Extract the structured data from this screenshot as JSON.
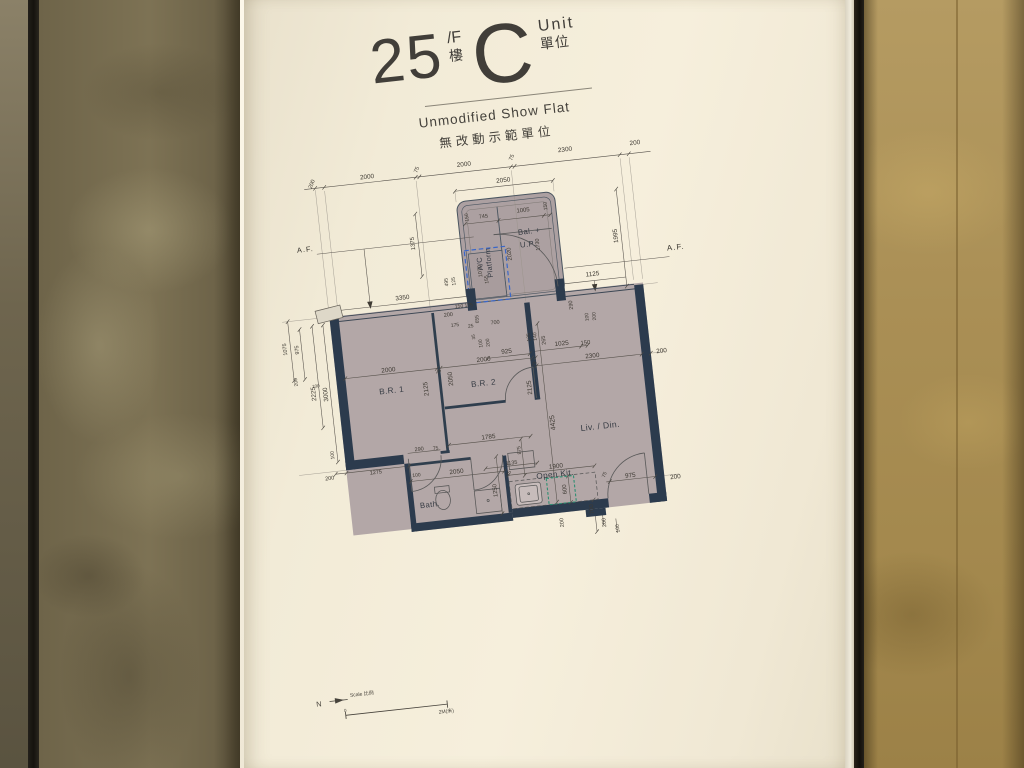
{
  "poster": {
    "title": {
      "floor": "25",
      "floor_sup": "/F",
      "floor_cjk": "樓",
      "unit": "C",
      "unit_en": "Unit",
      "unit_cjk": "單位"
    },
    "subtitle_en": "Unmodified Show Flat",
    "subtitle_cjk": "無改動示範單位"
  },
  "plan": {
    "rooms": [
      {
        "t": "B.R. 1",
        "x": 129,
        "y": 268,
        "s": 9
      },
      {
        "t": "B.R. 2",
        "x": 230,
        "y": 271,
        "s": 9
      },
      {
        "t": "Liv. / Din.",
        "x": 352,
        "y": 332,
        "s": 9.5
      },
      {
        "t": "Bath.",
        "x": 157,
        "y": 397,
        "s": 8.5
      },
      {
        "t": "Open Kit.",
        "x": 297,
        "y": 379,
        "s": 9
      },
      {
        "t": "Bal. +",
        "x": 298,
        "y": 111,
        "s": 8.5
      },
      {
        "t": "U.P.",
        "x": 295,
        "y": 125,
        "s": 8.5
      },
      {
        "t": "A/C",
        "x": 241,
        "y": 140,
        "s": 8,
        "r": -90
      },
      {
        "t": "Platform",
        "x": 251,
        "y": 140,
        "s": 8,
        "r": -90
      }
    ],
    "af_labels": [
      {
        "t": "A.F.",
        "x": 52,
        "y": 104,
        "s": 8
      },
      {
        "t": "A.F.",
        "x": 456,
        "y": 146,
        "s": 8.5
      }
    ],
    "misc": [
      {
        "t": "N",
        "x": 12,
        "y": 601,
        "s": 8
      },
      {
        "t": "Scale 比例",
        "x": 60,
        "y": 595,
        "s": 5.5
      },
      {
        "t": "0",
        "x": 40,
        "y": 611,
        "s": 5
      },
      {
        "t": "2M(米)",
        "x": 150,
        "y": 624,
        "s": 5.5
      }
    ],
    "dims": [
      {
        "t": "200",
        "x": 67,
        "y": 33,
        "r": -62,
        "s": 6
      },
      {
        "t": "2000",
        "x": 128,
        "y": 32,
        "s": 7
      },
      {
        "t": "75",
        "x": 183,
        "y": 30,
        "r": -62,
        "s": 6
      },
      {
        "t": "2000",
        "x": 235,
        "y": 30,
        "s": 7
      },
      {
        "t": "75",
        "x": 288,
        "y": 28,
        "r": -62,
        "s": 6
      },
      {
        "t": "2300",
        "x": 347,
        "y": 26,
        "s": 7
      },
      {
        "t": "200",
        "x": 424,
        "y": 27,
        "s": 7
      },
      {
        "t": "2050",
        "x": 276,
        "y": 52,
        "s": 7
      },
      {
        "t": "150",
        "x": 232,
        "y": 88,
        "r": -90,
        "s": 5.5
      },
      {
        "t": "745",
        "x": 250,
        "y": 89,
        "s": 6
      },
      {
        "t": "1005",
        "x": 294,
        "y": 87,
        "s": 6.5
      },
      {
        "t": "150",
        "x": 319,
        "y": 85,
        "r": -90,
        "s": 5.5
      },
      {
        "t": "1070",
        "x": 240,
        "y": 148,
        "r": -90,
        "s": 6
      },
      {
        "t": "2020",
        "x": 274,
        "y": 133,
        "r": -90,
        "s": 6.5
      },
      {
        "t": "1730",
        "x": 306,
        "y": 126,
        "r": -90,
        "s": 6
      },
      {
        "t": "290",
        "x": 335,
        "y": 196,
        "r": -90,
        "s": 6
      },
      {
        "t": "155",
        "x": 246,
        "y": 158,
        "r": -90,
        "s": 5.5
      },
      {
        "t": "1995",
        "x": 392,
        "y": 126,
        "r": -90,
        "s": 7
      },
      {
        "t": "1375",
        "x": 170,
        "y": 110,
        "r": -90,
        "s": 6.5
      },
      {
        "t": "3350",
        "x": 152,
        "y": 168,
        "s": 7
      },
      {
        "t": "495",
        "x": 202,
        "y": 156,
        "r": -90,
        "s": 5.5
      },
      {
        "t": "125",
        "x": 210,
        "y": 156,
        "r": -90,
        "s": 5.5
      },
      {
        "t": "150 175",
        "x": 218,
        "y": 184,
        "s": 5.5
      },
      {
        "t": "200",
        "x": 200,
        "y": 192,
        "s": 6
      },
      {
        "t": "175",
        "x": 206,
        "y": 204,
        "s": 5.5
      },
      {
        "t": "25",
        "x": 223,
        "y": 207,
        "s": 5.5
      },
      {
        "t": "655",
        "x": 231,
        "y": 200,
        "r": -90,
        "s": 5.5
      },
      {
        "t": "700",
        "x": 250,
        "y": 206,
        "s": 6
      },
      {
        "t": "35",
        "x": 225,
        "y": 219,
        "r": -90,
        "s": 5
      },
      {
        "t": "100",
        "x": 232,
        "y": 227,
        "r": -90,
        "s": 5.5
      },
      {
        "t": "200",
        "x": 240,
        "y": 227,
        "r": -90,
        "s": 5.5
      },
      {
        "t": "1125",
        "x": 362,
        "y": 165,
        "s": 7
      },
      {
        "t": "925",
        "x": 259,
        "y": 239,
        "s": 7
      },
      {
        "t": "125",
        "x": 285,
        "y": 226,
        "r": -90,
        "s": 5.5
      },
      {
        "t": "140",
        "x": 292,
        "y": 226,
        "r": -90,
        "s": 5.5
      },
      {
        "t": "265",
        "x": 301,
        "y": 231,
        "r": -90,
        "s": 6
      },
      {
        "t": "1025",
        "x": 320,
        "y": 237,
        "s": 7
      },
      {
        "t": "150",
        "x": 346,
        "y": 239,
        "s": 6.5
      },
      {
        "t": "100",
        "x": 351,
        "y": 211,
        "r": -90,
        "s": 5.5
      },
      {
        "t": "200",
        "x": 359,
        "y": 211,
        "r": -90,
        "s": 5.5
      },
      {
        "t": "2000",
        "x": 128,
        "y": 245,
        "s": 7
      },
      {
        "t": "75",
        "x": 183,
        "y": 253,
        "r": -62,
        "s": 5.5
      },
      {
        "t": "2000",
        "x": 233,
        "y": 245,
        "s": 7
      },
      {
        "t": "75",
        "x": 288,
        "y": 256,
        "r": -62,
        "s": 5.5
      },
      {
        "t": "2300",
        "x": 352,
        "y": 254,
        "s": 7
      },
      {
        "t": "200",
        "x": 428,
        "y": 257,
        "s": 7
      },
      {
        "t": "2125",
        "x": 167,
        "y": 270,
        "r": -90,
        "s": 7
      },
      {
        "t": "2050",
        "x": 195,
        "y": 262,
        "r": -90,
        "s": 7
      },
      {
        "t": "2125",
        "x": 280,
        "y": 281,
        "r": -90,
        "s": 7
      },
      {
        "t": "4425",
        "x": 301,
        "y": 322,
        "r": -90,
        "s": 7.5
      },
      {
        "t": "3000",
        "x": 57,
        "y": 264,
        "r": -90,
        "s": 7
      },
      {
        "t": "2225",
        "x": 44,
        "y": 262,
        "r": -90,
        "s": 7
      },
      {
        "t": "1075",
        "x": 18,
        "y": 210,
        "r": -90,
        "s": 6
      },
      {
        "t": "975",
        "x": 31,
        "y": 212,
        "r": -90,
        "s": 6
      },
      {
        "t": "200",
        "x": 26,
        "y": 247,
        "r": -90,
        "s": 5.5
      },
      {
        "t": "100",
        "x": 47,
        "y": 254,
        "s": 5
      },
      {
        "t": "100",
        "x": 57,
        "y": 331,
        "r": -90,
        "s": 5.5
      },
      {
        "t": "200",
        "x": 51,
        "y": 356,
        "s": 6
      },
      {
        "t": "1275",
        "x": 102,
        "y": 355,
        "s": 6
      },
      {
        "t": "100",
        "x": 146,
        "y": 363,
        "s": 5.5
      },
      {
        "t": "290",
        "x": 152,
        "y": 335,
        "s": 6
      },
      {
        "t": "75",
        "x": 170,
        "y": 336,
        "s": 5.5
      },
      {
        "t": "1785",
        "x": 229,
        "y": 330,
        "s": 7
      },
      {
        "t": "875",
        "x": 261,
        "y": 348,
        "r": -90,
        "s": 5.5
      },
      {
        "t": "1135",
        "x": 251,
        "y": 361,
        "s": 6
      },
      {
        "t": "75",
        "x": 247,
        "y": 372,
        "r": -62,
        "s": 5.5
      },
      {
        "t": "2050",
        "x": 190,
        "y": 364,
        "s": 7
      },
      {
        "t": "1250",
        "x": 230,
        "y": 389,
        "r": -90,
        "s": 6.5
      },
      {
        "t": "1900",
        "x": 299,
        "y": 370,
        "s": 7
      },
      {
        "t": "600",
        "x": 306,
        "y": 396,
        "r": -90,
        "s": 6.5
      },
      {
        "t": "75",
        "x": 351,
        "y": 385,
        "r": -62,
        "s": 5.5
      },
      {
        "t": "975",
        "x": 379,
        "y": 389,
        "s": 7
      },
      {
        "t": "200",
        "x": 428,
        "y": 396,
        "s": 7
      },
      {
        "t": "700",
        "x": 333,
        "y": 421,
        "r": -90,
        "s": 6.5
      },
      {
        "t": "200",
        "x": 345,
        "y": 437,
        "r": -90,
        "s": 6
      },
      {
        "t": "100",
        "x": 359,
        "y": 445,
        "r": -90,
        "s": 5.5
      },
      {
        "t": "200",
        "x": 299,
        "y": 432,
        "r": -90,
        "s": 6
      }
    ]
  }
}
